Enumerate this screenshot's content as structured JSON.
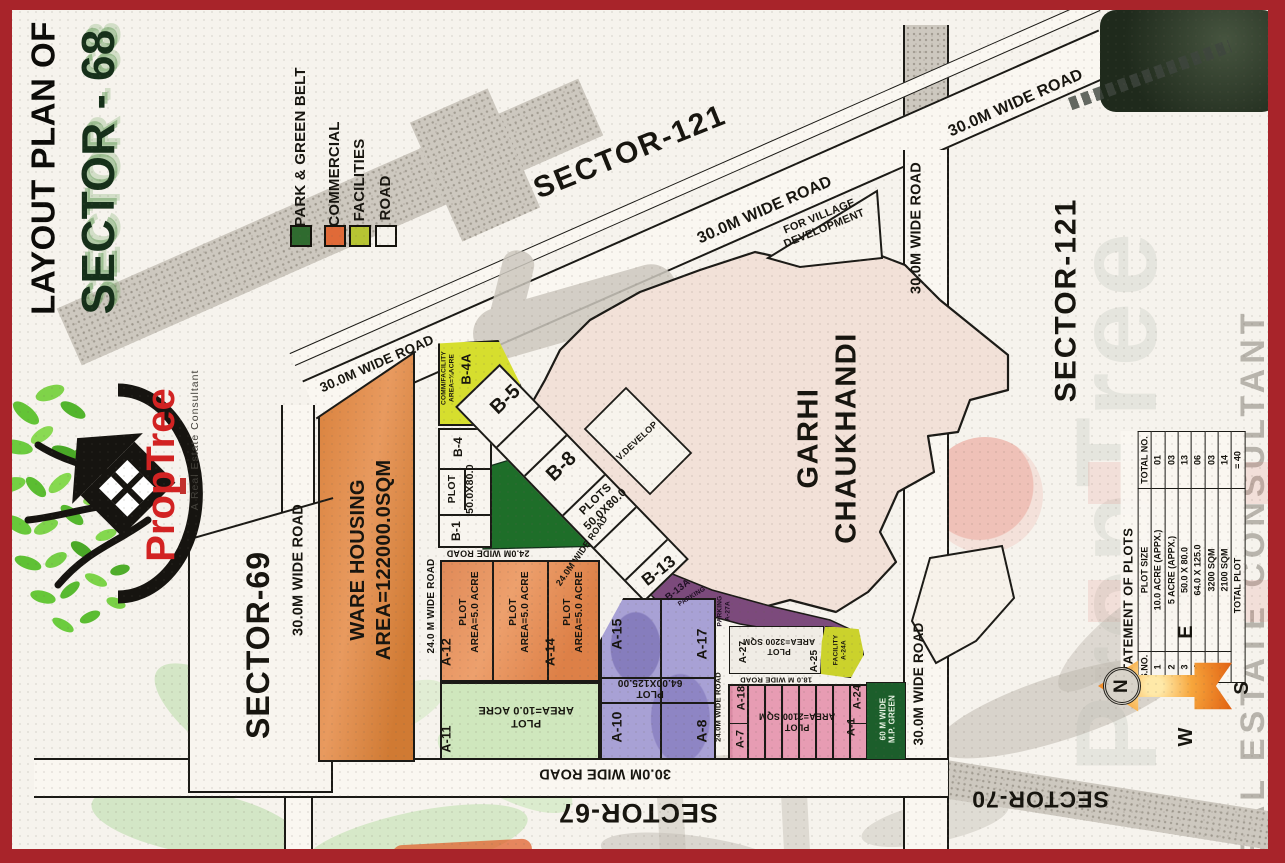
{
  "title": {
    "line1": "LAYOUT PLAN OF",
    "line2": "SECTOR - 68"
  },
  "legend": {
    "items": [
      {
        "label": "PARK & GREEN BELT",
        "color": "#2f6b2f"
      },
      {
        "label": "COMMERCIAL",
        "color": "#e06a38"
      },
      {
        "label": "FACILITIES",
        "color": "#b7c433"
      },
      {
        "label": "ROAD",
        "color": "#f6f3ec"
      }
    ]
  },
  "sectors": {
    "sector121": "SECTOR-121",
    "sector69": "SECTOR-69",
    "sector67": "SECTOR-67",
    "sector70": "SECTOR-70"
  },
  "roads": {
    "wide30": "30.0M WIDE ROAD",
    "wide24": "24.0M WIDE ROAD",
    "wide24sp": "24.0 M WIDE ROAD",
    "wide18": "18.0 M WIDE ROAD"
  },
  "village": {
    "name": "GARHI\nCHAUKHANDI",
    "for_village": "FOR VILLAGE\nDEVELOPMENT",
    "v_develop": "V.DEVELOP"
  },
  "warehouse": {
    "label": "WARE HOUSING\nAREA=122000.0SQM"
  },
  "plots": {
    "b4a": "B-4A",
    "b4a_note": "COMM/FACILITY\nAREA=¾ACRE",
    "b4": "B-4",
    "b1": "B-1",
    "plot_word": "PLOT",
    "size_50x80": "50.0X80.0",
    "b5": "B-5",
    "b8": "B-8",
    "plots_50x80": "PLOTS\n50.0X80.0",
    "b13": "B-13",
    "b13a": "B-13A",
    "parking": "PARKING",
    "parking_a27a": "PARKING\nA-27A",
    "a12": "A-12",
    "a14": "A-14",
    "area5": "PLOT\nAREA=5.0 ACRE",
    "a11": "A-11",
    "area10": "PLOT\nAREA=10.0 ACRE",
    "a15": "A-15",
    "a17": "A-17",
    "a10": "A-10",
    "a8": "A-8",
    "size_64x125": "PLOT\n64.00X125.00",
    "a27": "A-27",
    "area3200": "PLOT\nAREA=3200 SQM",
    "a25": "A-25",
    "facility_a24a": "FACILITY\nA-24A",
    "a18": "A-18",
    "a7": "A-7",
    "area2100": "PLOT\nAREA=2100 SQM",
    "a24": "A-24",
    "a1": "A-1",
    "mp_green": "60 M WIDE\nM.P. GREEN"
  },
  "table": {
    "title": "STATEMENT OF PLOTS",
    "headers": [
      "S.NO.",
      "PLOT SIZE",
      "TOTAL NO."
    ],
    "rows": [
      [
        "1",
        "10.0 ACRE (APPX.)",
        "01"
      ],
      [
        "2",
        "5 ACRE (APPX.)",
        "03"
      ],
      [
        "3",
        "50.0 X 80.0",
        "13"
      ],
      [
        "4",
        "64.0 X 125.0",
        "06"
      ],
      [
        "5",
        "3200 SQM",
        "03"
      ],
      [
        "6",
        "2100 SQM",
        "14"
      ]
    ],
    "footer": {
      "label": "TOTAL PLOT",
      "value": "= 40"
    }
  },
  "compass": {
    "n": "N",
    "e": "E",
    "s": "S",
    "w": "W"
  },
  "logo": {
    "name": "PropTree",
    "tagline": "A Real Estate Consultant"
  },
  "watermarks": {
    "brand": "PropTree",
    "consultant": "REAL ESTATE CONSULTANT"
  }
}
